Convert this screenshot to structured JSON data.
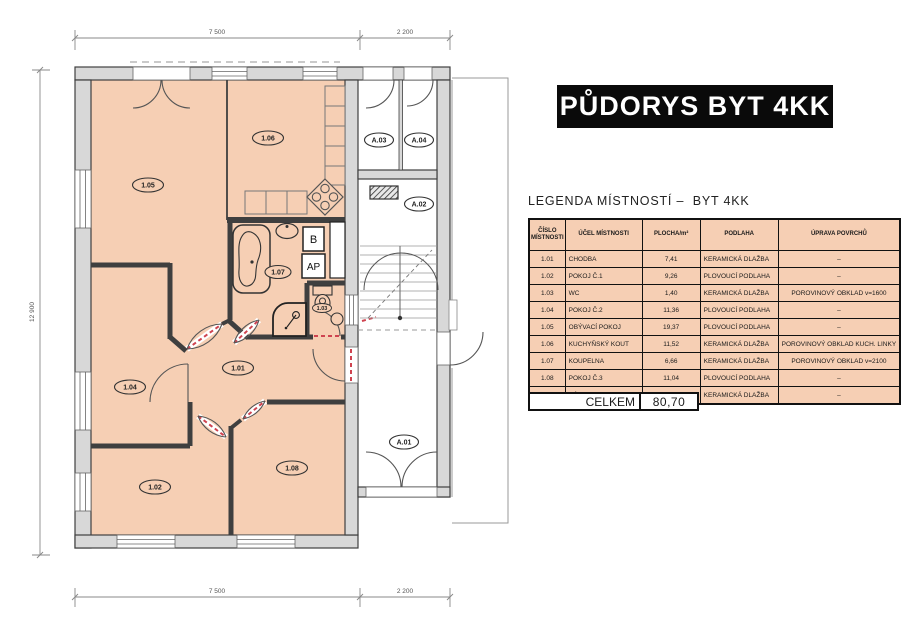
{
  "title": "PŮDORYS BYT 4KK",
  "legend": {
    "heading": "LEGENDA MÍSTNOSTÍ –  BYT 4KK",
    "table": {
      "headers": [
        "ČÍSLO MÍSTNOSTI",
        "ÚČEL MÍSTNOSTI",
        "PLOCHA/m²",
        "PODLAHA",
        "ÚPRAVA POVRCHŮ"
      ],
      "rows": [
        [
          "1.01",
          "CHODBA",
          "7,41",
          "KERAMICKÁ DLAŽBA",
          "–"
        ],
        [
          "1.02",
          "POKOJ Č.1",
          "9,26",
          "PLOVOUCÍ PODLAHA",
          "–"
        ],
        [
          "1.03",
          "WC",
          "1,40",
          "KERAMICKÁ DLAŽBA",
          "POROVINOVÝ OBKLAD v=1600"
        ],
        [
          "1.04",
          "POKOJ Č.2",
          "11,36",
          "PLOVOUCÍ PODLAHA",
          "–"
        ],
        [
          "1.05",
          "OBÝVACÍ POKOJ",
          "19,37",
          "PLOVOUCÍ PODLAHA",
          "–"
        ],
        [
          "1.06",
          "KUCHYŇSKÝ KOUT",
          "11,52",
          "KERAMICKÁ DLAŽBA",
          "POROVINOVÝ OBKLAD KUCH. LINKY"
        ],
        [
          "1.07",
          "KOUPELNA",
          "6,66",
          "KERAMICKÁ DLAŽBA",
          "POROVINOVÝ OBKLAD v=2100"
        ],
        [
          "1.08",
          "POKOJ Č.3",
          "11,04",
          "PLOVOUCÍ PODLAHA",
          "–"
        ],
        [
          "A.03",
          "KÓJE č.1",
          "2,68",
          "KERAMICKÁ DLAŽBA",
          "–"
        ]
      ],
      "total_label": "CELKEM",
      "total_value": "80,70"
    }
  },
  "plan": {
    "labels": {
      "r101": "1.01",
      "r102": "1.02",
      "r103": "1.03",
      "r104": "1.04",
      "r105": "1.05",
      "r106": "1.06",
      "r107": "1.07",
      "r108": "1.08",
      "a01": "A.01",
      "a02": "A.02",
      "a03": "A.03",
      "a04": "A.04"
    },
    "fixtures": {
      "boiler": "B",
      "washer": "AP"
    },
    "dimensions": {
      "top_main": "7 500",
      "top_wing": "2 200",
      "left": "12 900",
      "bottom_main": "7 500",
      "bottom_wing": "2 200"
    }
  },
  "colors": {
    "room_fill": "#f6cfb4",
    "wall_fill": "#d8d8d8",
    "wall_line": "#3f3f3f",
    "door_dash": "#cf4350",
    "title_bg": "#0a0a0a",
    "title_fg": "#ffffff"
  }
}
